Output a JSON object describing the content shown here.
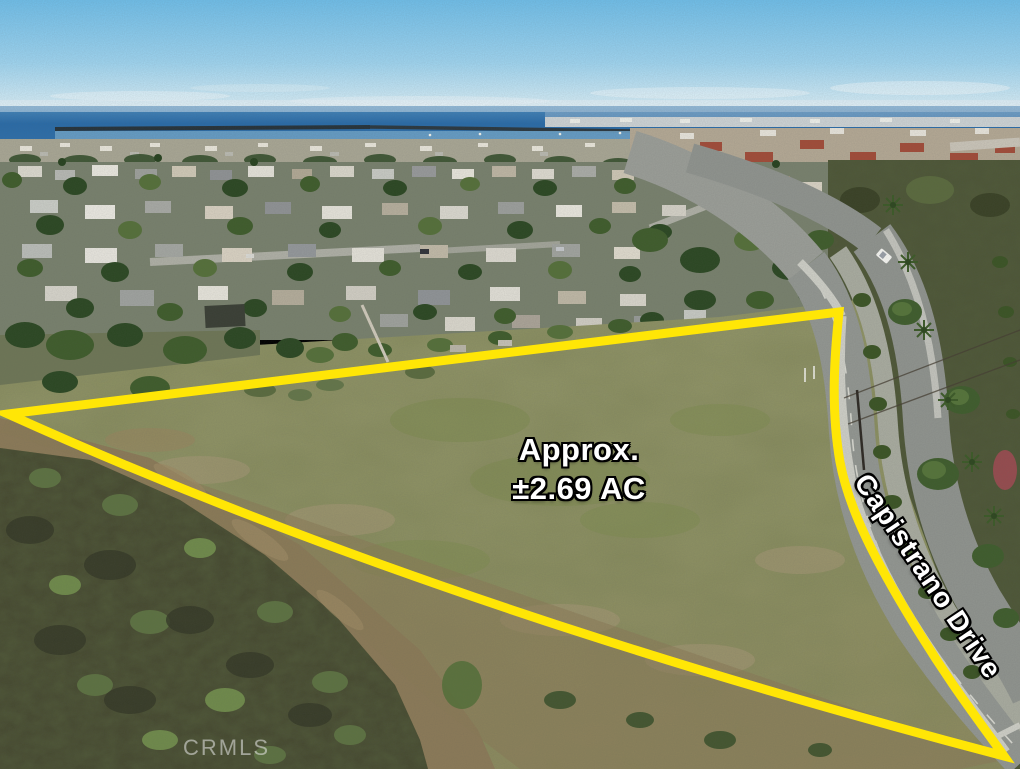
{
  "photo": {
    "watermark": "CRMLS"
  },
  "annotations": {
    "acreage_label": {
      "line1": "Approx.",
      "line2": "±2.69 AC"
    },
    "street_label": "Capistrano Drive",
    "boundary_color": "#ffe606",
    "label_text_color": "#ffffff",
    "label_outline_color": "#000000",
    "watermark_color": "rgba(234,234,234,0.55)"
  }
}
